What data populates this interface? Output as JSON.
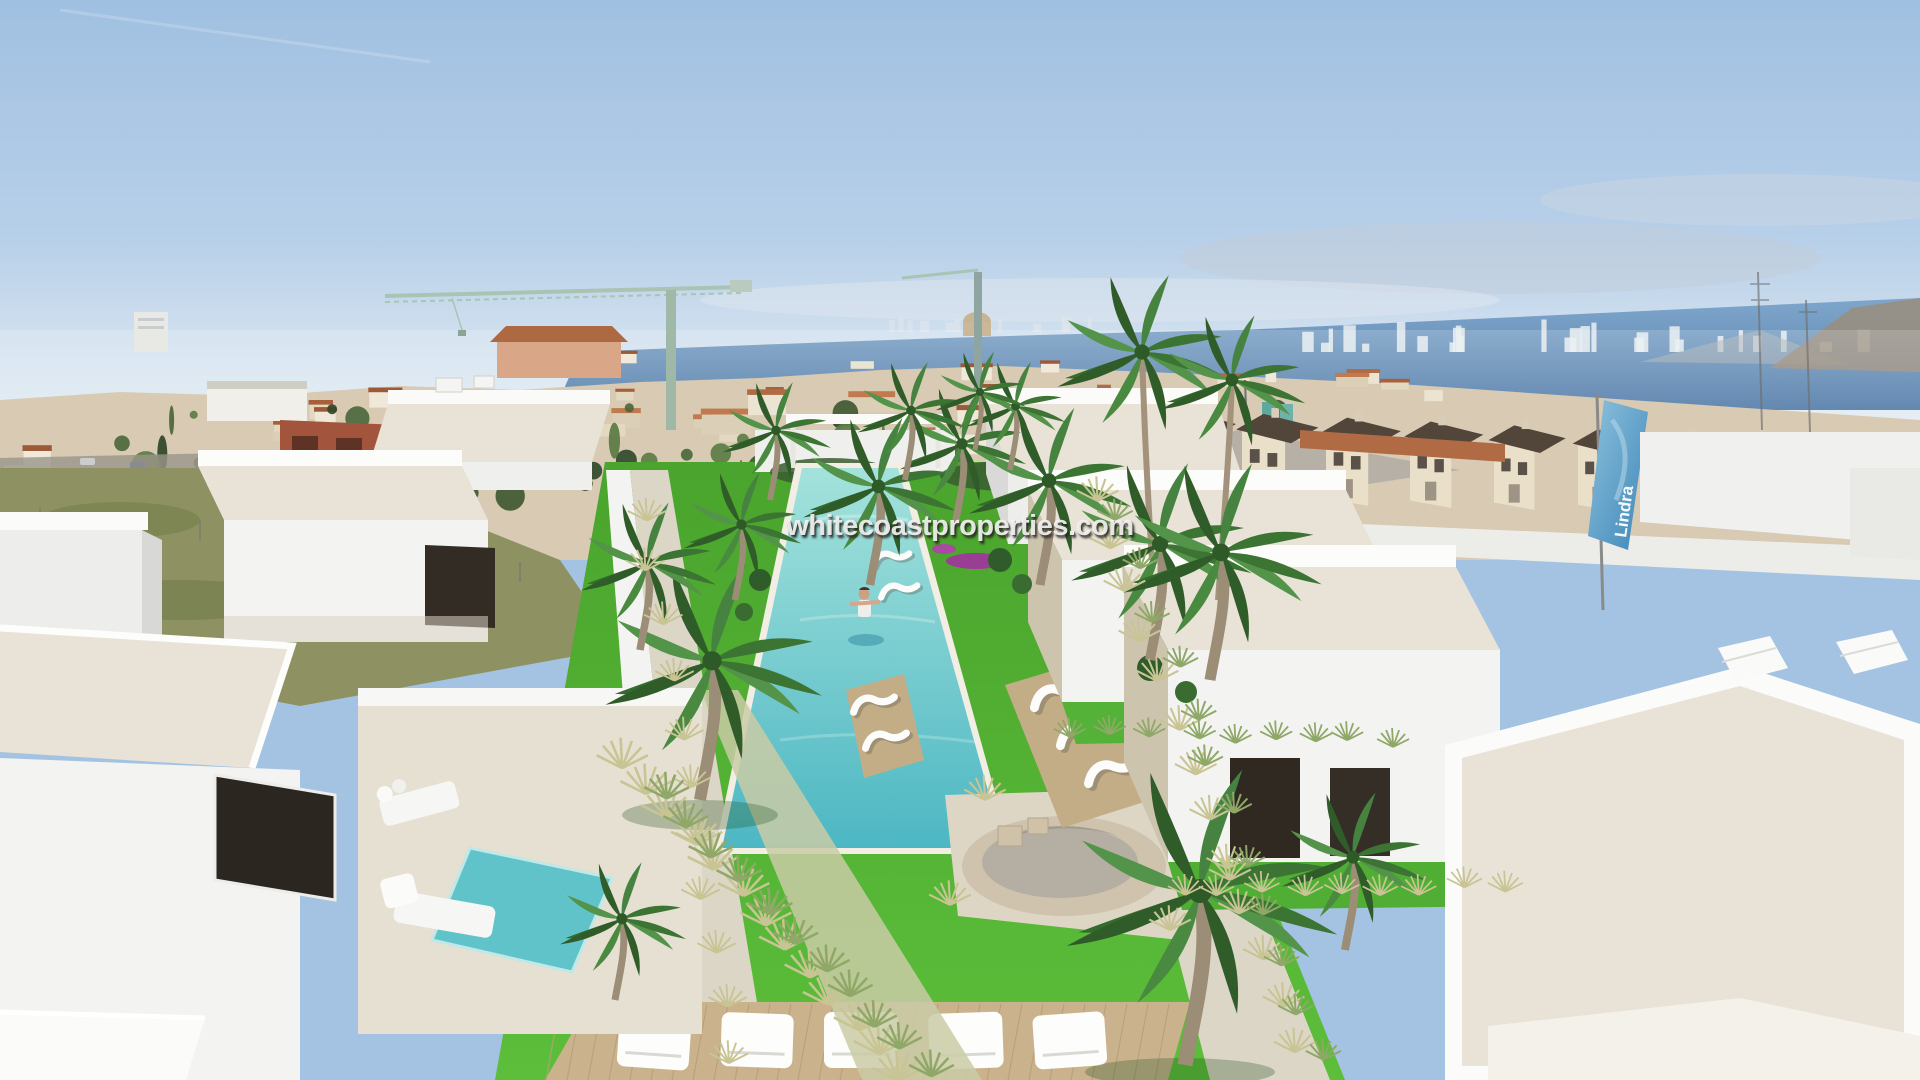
{
  "meta": {
    "title": "Aerial render of a villa development",
    "description": "3D architectural rendering: rows of white modern villas with private plunge pools flanking a communal garden with a long turquoise pool, circular spa, wooden sun decks, white loungers and palm trees; Mediterranean town, construction cranes, sea and a distant high-rise skyline behind."
  },
  "watermark": {
    "text": "whitecoastproperties.com"
  },
  "flag": {
    "label": "Lindra",
    "color": "#4f97c4"
  },
  "palette": {
    "sky-top": "#a4c3e3",
    "sky-horizon": "#eaf1f5",
    "sea": "#5d85b0",
    "town-base": "#d8cab3",
    "terracotta": "#b06b45",
    "villa-white": "#f3f3f1",
    "roof-gravel": "#e8e3d6",
    "stone-accent": "#cdc4ae",
    "pool-water": "#5fc3c9",
    "lawn": "#4fae33",
    "walkway": "#dcd6c6",
    "deck-wood": "#c9b28c",
    "palm-green": "#3f7a35",
    "crane": "#a9c4b3",
    "field-scrub": "#8e9262",
    "brick": "#a2543c"
  }
}
